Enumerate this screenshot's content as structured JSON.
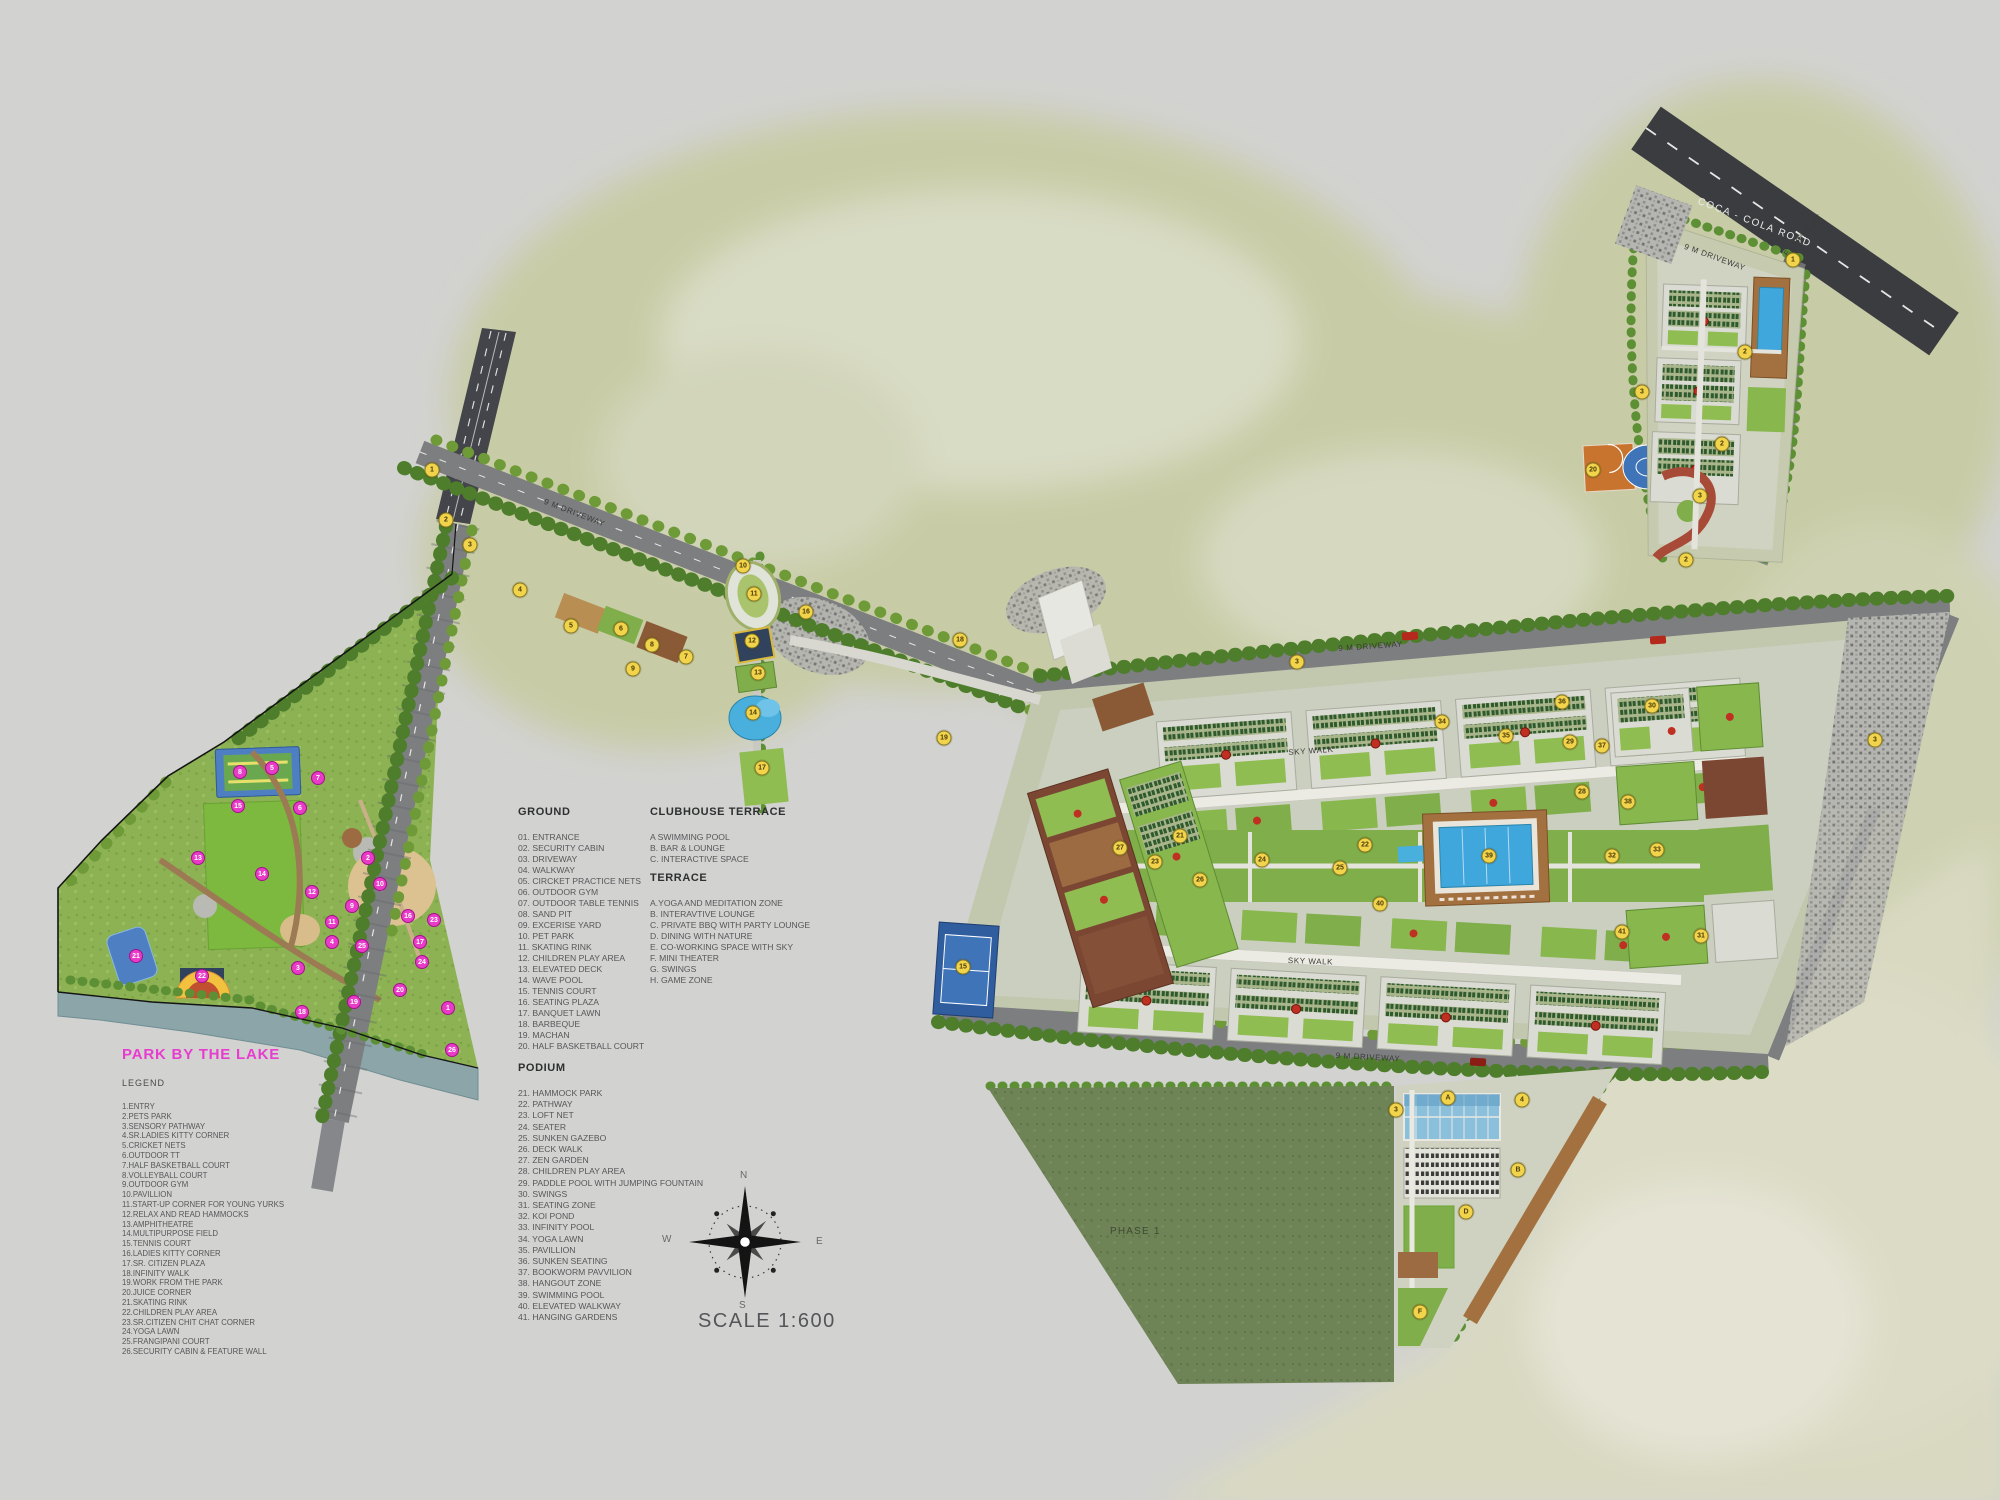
{
  "park_legend": {
    "title": "PARK BY THE LAKE",
    "heading": "LEGEND",
    "items": [
      "1.ENTRY",
      "2.PETS PARK",
      "3.SENSORY PATHWAY",
      "4.SR.LADIES KITTY CORNER",
      "5.CRICKET NETS",
      "6.OUTDOOR TT",
      "7.HALF BASKETBALL COURT",
      "8.VOLLEYBALL COURT",
      "9.OUTDOOR GYM",
      "10.PAVILLION",
      "11.START-UP CORNER FOR YOUNG YURKS",
      "12.RELAX AND READ HAMMOCKS",
      "13.AMPHITHEATRE",
      "14.MULTIPURPOSE FIELD",
      "15.TENNIS COURT",
      "16.LADIES KITTY CORNER",
      "17.SR. CITIZEN PLAZA",
      "18.INFINITY WALK",
      "19.WORK FROM THE PARK",
      "20.JUICE CORNER",
      "21.SKATING RINK",
      "22.CHILDREN PLAY AREA",
      "23.SR.CITIZEN CHIT CHAT CORNER",
      "24.YOGA LAWN",
      "25.FRANGIPANI COURT",
      "26.SECURITY CABIN & FEATURE WALL"
    ]
  },
  "ground_legend": {
    "title": "GROUND",
    "items": [
      "01. ENTRANCE",
      "02. SECURITY CABIN",
      "03. DRIVEWAY",
      "04. WALKWAY",
      "05. CIRCKET PRACTICE NETS",
      "06. OUTDOOR GYM",
      "07. OUTDOOR TABLE TENNIS",
      "08. SAND PIT",
      "09. EXCERISE YARD",
      "10. PET PARK",
      "11. SKATING RINK",
      "12. CHILDREN PLAY AREA",
      "13. ELEVATED DECK",
      "14. WAVE POOL",
      "15. TENNIS COURT",
      "16. SEATING PLAZA",
      "17. BANQUET LAWN",
      "18. BARBEQUE",
      "19. MACHAN",
      "20. HALF BASKETBALL COURT"
    ]
  },
  "clubhouse_terrace_legend": {
    "title": "CLUBHOUSE TERRACE",
    "items": [
      "A SWIMMING POOL",
      "B. BAR & LOUNGE",
      "C. INTERACTIVE SPACE"
    ]
  },
  "terrace_legend": {
    "title": "TERRACE",
    "items": [
      "A.YOGA AND MEDITATION ZONE",
      "B. INTERAVTIVE LOUNGE",
      "C.  PRIVATE BBQ WITH PARTY LOUNGE",
      "D. DINING WITH NATURE",
      "E. CO-WORKING SPACE WITH SKY",
      "F. MINI THEATER",
      "G. SWINGS",
      "H. GAME ZONE"
    ]
  },
  "podium_legend": {
    "title": "PODIUM",
    "items": [
      "21. HAMMOCK PARK",
      "22. PATHWAY",
      "23. LOFT NET",
      "24. SEATER",
      "25. SUNKEN GAZEBO",
      "26. DECK WALK",
      "27. ZEN GARDEN",
      "28. CHILDREN PLAY AREA",
      "29. PADDLE POOL WITH JUMPING FOUNTAIN",
      "30. SWINGS",
      "31. SEATING ZONE",
      "32. KOI POND",
      "33. INFINITY POOL",
      "34. YOGA LAWN",
      "35. PAVILLION",
      "36. SUNKEN SEATING",
      "37. BOOKWORM PAVVILION",
      "38. HANGOUT ZONE",
      "39. SWIMMING POOL",
      "40. ELEVATED WALKWAY",
      "41. HANGING GARDENS"
    ]
  },
  "map_labels": [
    {
      "text": "COCA - COLA ROAD",
      "x": 1700,
      "y": 196,
      "rot": 21,
      "cls": "coca"
    },
    {
      "text": "ENTRY/EXIT",
      "x": 1782,
      "y": 252,
      "rot": -48,
      "cls": "tinyd"
    },
    {
      "text": "9 M DRIVEWAY",
      "x": 1686,
      "y": 242,
      "rot": 20,
      "cls": "tinyd"
    },
    {
      "text": "9 M DRIVEWAY",
      "x": 546,
      "y": 497,
      "rot": 21,
      "cls": "tinyd"
    },
    {
      "text": "9 M DRIVEWAY",
      "x": 1338,
      "y": 644,
      "rot": -4,
      "cls": "tinyd"
    },
    {
      "text": "9 M DRIVEWAY",
      "x": 1336,
      "y": 1051,
      "rot": 3,
      "cls": "tinyd"
    },
    {
      "text": "SKY WALK",
      "x": 1288,
      "y": 748,
      "rot": -4,
      "cls": "tinyd"
    },
    {
      "text": "SKY WALK",
      "x": 1288,
      "y": 956,
      "rot": 2,
      "cls": "tinyd"
    },
    {
      "text": "PHASE 1",
      "x": 1110,
      "y": 1226,
      "rot": 0,
      "cls": "phase"
    },
    {
      "text": "SCALE 1:600",
      "x": 698,
      "y": 1310,
      "rot": 0,
      "cls": "scale"
    },
    {
      "text": "N",
      "x": 740,
      "y": 1170,
      "rot": 0,
      "cls": "cdir"
    },
    {
      "text": "W",
      "x": 662,
      "y": 1234,
      "rot": 0,
      "cls": "cdir"
    },
    {
      "text": "E",
      "x": 816,
      "y": 1236,
      "rot": 0,
      "cls": "cdir"
    },
    {
      "text": "S",
      "x": 739,
      "y": 1300,
      "rot": 0,
      "cls": "cdir"
    }
  ],
  "markers": {
    "yellow": [
      {
        "n": "1",
        "x": 432,
        "y": 470
      },
      {
        "n": "2",
        "x": 446,
        "y": 520
      },
      {
        "n": "3",
        "x": 470,
        "y": 545
      },
      {
        "n": "4",
        "x": 520,
        "y": 590
      },
      {
        "n": "5",
        "x": 571,
        "y": 626
      },
      {
        "n": "6",
        "x": 621,
        "y": 629
      },
      {
        "n": "8",
        "x": 652,
        "y": 645
      },
      {
        "n": "7",
        "x": 686,
        "y": 657
      },
      {
        "n": "9",
        "x": 633,
        "y": 669
      },
      {
        "n": "10",
        "x": 743,
        "y": 566
      },
      {
        "n": "11",
        "x": 754,
        "y": 594
      },
      {
        "n": "12",
        "x": 752,
        "y": 641
      },
      {
        "n": "13",
        "x": 758,
        "y": 673
      },
      {
        "n": "14",
        "x": 753,
        "y": 713
      },
      {
        "n": "17",
        "x": 762,
        "y": 768
      },
      {
        "n": "16",
        "x": 806,
        "y": 612
      },
      {
        "n": "18",
        "x": 960,
        "y": 640
      },
      {
        "n": "19",
        "x": 944,
        "y": 738
      },
      {
        "n": "15",
        "x": 963,
        "y": 967
      },
      {
        "n": "20",
        "x": 1593,
        "y": 470
      },
      {
        "n": "3",
        "x": 1297,
        "y": 662
      },
      {
        "n": "3",
        "x": 1875,
        "y": 740
      },
      {
        "n": "21",
        "x": 1180,
        "y": 836
      },
      {
        "n": "24",
        "x": 1262,
        "y": 860
      },
      {
        "n": "22",
        "x": 1365,
        "y": 845
      },
      {
        "n": "25",
        "x": 1340,
        "y": 868
      },
      {
        "n": "27",
        "x": 1120,
        "y": 848
      },
      {
        "n": "28",
        "x": 1582,
        "y": 792
      },
      {
        "n": "29",
        "x": 1570,
        "y": 742
      },
      {
        "n": "30",
        "x": 1652,
        "y": 706
      },
      {
        "n": "31",
        "x": 1701,
        "y": 936
      },
      {
        "n": "32",
        "x": 1612,
        "y": 856
      },
      {
        "n": "33",
        "x": 1657,
        "y": 850
      },
      {
        "n": "34",
        "x": 1442,
        "y": 722
      },
      {
        "n": "35",
        "x": 1506,
        "y": 736
      },
      {
        "n": "36",
        "x": 1562,
        "y": 702
      },
      {
        "n": "37",
        "x": 1602,
        "y": 746
      },
      {
        "n": "38",
        "x": 1628,
        "y": 802
      },
      {
        "n": "39",
        "x": 1489,
        "y": 856
      },
      {
        "n": "40",
        "x": 1380,
        "y": 904
      },
      {
        "n": "41",
        "x": 1622,
        "y": 932
      },
      {
        "n": "26",
        "x": 1200,
        "y": 880
      },
      {
        "n": "23",
        "x": 1155,
        "y": 862
      },
      {
        "n": "1",
        "x": 1793,
        "y": 260
      },
      {
        "n": "2",
        "x": 1745,
        "y": 352
      },
      {
        "n": "2",
        "x": 1722,
        "y": 444
      },
      {
        "n": "3",
        "x": 1700,
        "y": 496
      },
      {
        "n": "3",
        "x": 1642,
        "y": 392
      },
      {
        "n": "2",
        "x": 1686,
        "y": 560
      },
      {
        "n": "3",
        "x": 1396,
        "y": 1110
      },
      {
        "n": "A",
        "x": 1448,
        "y": 1098
      },
      {
        "n": "4",
        "x": 1522,
        "y": 1100
      },
      {
        "n": "B",
        "x": 1518,
        "y": 1170
      },
      {
        "n": "D",
        "x": 1466,
        "y": 1212
      },
      {
        "n": "F",
        "x": 1420,
        "y": 1312
      }
    ],
    "magenta": [
      {
        "n": "1",
        "x": 448,
        "y": 1008
      },
      {
        "n": "2",
        "x": 368,
        "y": 858
      },
      {
        "n": "3",
        "x": 298,
        "y": 968
      },
      {
        "n": "4",
        "x": 332,
        "y": 942
      },
      {
        "n": "5",
        "x": 272,
        "y": 768
      },
      {
        "n": "6",
        "x": 300,
        "y": 808
      },
      {
        "n": "7",
        "x": 318,
        "y": 778
      },
      {
        "n": "8",
        "x": 240,
        "y": 772
      },
      {
        "n": "9",
        "x": 352,
        "y": 906
      },
      {
        "n": "10",
        "x": 380,
        "y": 884
      },
      {
        "n": "11",
        "x": 332,
        "y": 922
      },
      {
        "n": "12",
        "x": 312,
        "y": 892
      },
      {
        "n": "13",
        "x": 198,
        "y": 858
      },
      {
        "n": "14",
        "x": 262,
        "y": 874
      },
      {
        "n": "15",
        "x": 238,
        "y": 806
      },
      {
        "n": "16",
        "x": 408,
        "y": 916
      },
      {
        "n": "17",
        "x": 420,
        "y": 942
      },
      {
        "n": "18",
        "x": 302,
        "y": 1012
      },
      {
        "n": "19",
        "x": 354,
        "y": 1002
      },
      {
        "n": "20",
        "x": 400,
        "y": 990
      },
      {
        "n": "21",
        "x": 136,
        "y": 956
      },
      {
        "n": "22",
        "x": 202,
        "y": 976
      },
      {
        "n": "23",
        "x": 434,
        "y": 920
      },
      {
        "n": "24",
        "x": 422,
        "y": 962
      },
      {
        "n": "25",
        "x": 362,
        "y": 946
      },
      {
        "n": "26",
        "x": 452,
        "y": 1050
      }
    ]
  },
  "colors": {
    "background": "#d2d2d0",
    "open_land": "#c8cca6",
    "park_green": "#8db253",
    "phase_green": "#6e8356",
    "road_gray": "#7c7e80",
    "road_dark": "#3a3c40",
    "water_blue": "#3fa7dc",
    "lake_gray": "#8ba5a9",
    "deck_brown": "#a3713f",
    "marker_yellow": "#f2d44c",
    "marker_magenta": "#e83bc8",
    "title_magenta": "#e83bd0",
    "red_accent": "#c03022",
    "lawn_bright": "#7cb93e"
  }
}
